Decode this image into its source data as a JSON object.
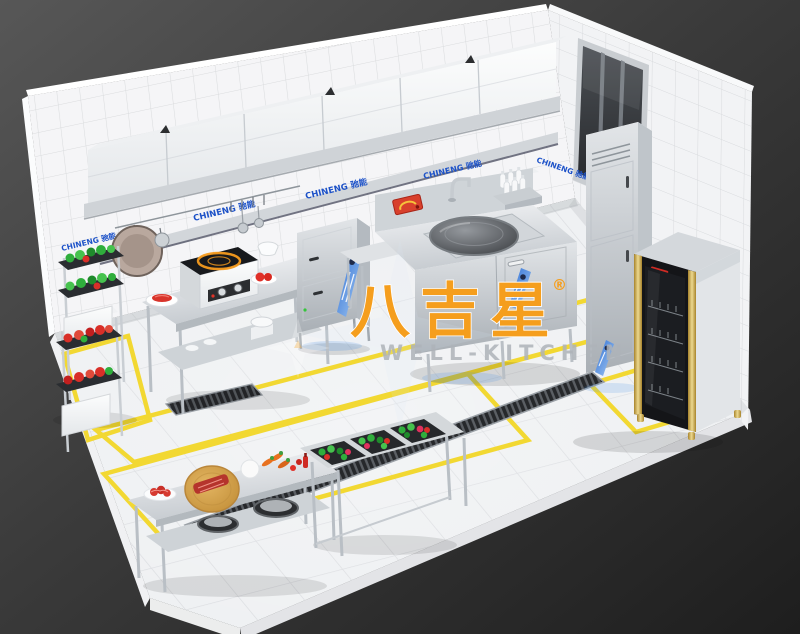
{
  "branding": {
    "wall_banner_label": "CHINENG 驰能",
    "banner_count": 5
  },
  "watermark": {
    "cn": "八吉星",
    "registered_mark": "®",
    "en": "WELL-KITCHEN"
  },
  "colors": {
    "background": "#2e2e2e",
    "wall_tile": "#f4f4f6",
    "floor_tile": "#eef0f2",
    "stainless_steel": "#c9ced3",
    "banner_blue": "#1d52c8",
    "sticker_blue": "#2e6fd4",
    "safety_yellow": "#f2d832",
    "watermark_orange": "#f59e1d",
    "watermark_gray": "#aeb3b9",
    "vegetable_green": "#2fae3c",
    "vegetable_red": "#d92f28",
    "cabinet_gold": "#d8b45a",
    "induction_ring_orange": "#f59b1e"
  },
  "scene": {
    "description": "Isometric 3D render of a commercial kitchen with white tiled walls, marble tile floor, yellow floor zone markings, floor drain trenches and stainless steel equipment",
    "objects": [
      "range hood with cabinet row",
      "wall shelf",
      "hanging frying pan and ladles",
      "vegetable storage racks",
      "induction cooker prep table",
      "steam cabinet",
      "large single wok range with faucet",
      "condiment bottle rack",
      "dark window",
      "upright two-door fridge",
      "disinfection cabinet with gold trim",
      "prep table with wooden cutting board and meat",
      "triple sink filled with vegetables",
      "floor drain trench grates"
    ]
  }
}
